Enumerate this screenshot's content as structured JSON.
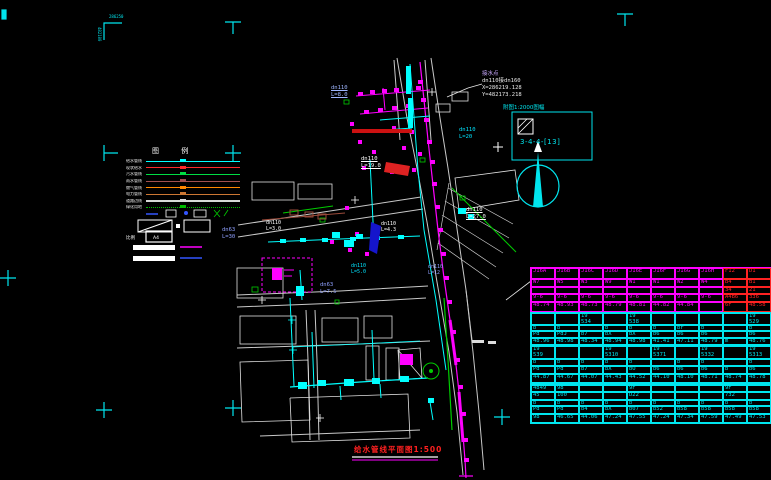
{
  "window": {
    "background": "#000000"
  },
  "frame": {
    "corner_coord_x": "286250",
    "corner_coord_y": "482100"
  },
  "legend": {
    "title": "图 例",
    "items": [
      {
        "label": "给水管线",
        "color": "#00ffff"
      },
      {
        "label": "现状给水",
        "color": "#ff2a2a"
      },
      {
        "label": "污水管线",
        "color": "#00dd44"
      },
      {
        "label": "雨水管线",
        "color": "#a05050"
      },
      {
        "label": "燃气管线",
        "color": "#ff8800"
      },
      {
        "label": "电力管线",
        "color": "#cc7733"
      },
      {
        "label": "道路边线",
        "color": "#d8d8d8",
        "thick": true
      },
      {
        "label": "绿化用地",
        "color": "#00bb00",
        "style": "dotted"
      }
    ],
    "scale_label": "比例",
    "sheet_label": "A4"
  },
  "callout": {
    "line1": "接水点",
    "line2": "dn110接dn160",
    "line3": "X=286219.128",
    "line4": "Y=482173.218"
  },
  "inset": {
    "caption": "附图1:2000图幅",
    "code": "3-4-4-[13]"
  },
  "title_block": {
    "title": "给水管线平面图1:500"
  },
  "map": {
    "labels": [
      {
        "text": "dn110\nL=8.0",
        "x": 331,
        "y": 85,
        "color": "#9fb6ff",
        "size": 5.5,
        "underline": true
      },
      {
        "text": "dn110\nL=20",
        "x": 459,
        "y": 127,
        "color": "#00e5ff",
        "size": 5.5
      },
      {
        "text": "dn110\nL=19.0",
        "x": 361,
        "y": 156,
        "color": "#ffffff",
        "size": 5.5,
        "underline": true
      },
      {
        "text": "dn110\nL=27.0",
        "x": 466,
        "y": 207,
        "color": "#ffffff",
        "size": 5.5,
        "underline": true
      },
      {
        "text": "dn63\nL=30",
        "x": 222,
        "y": 227,
        "color": "#8fa0ff",
        "size": 5.5
      },
      {
        "text": "dn110\nL=3.0",
        "x": 266,
        "y": 220,
        "color": "#ffffff",
        "size": 5
      },
      {
        "text": "dn110\nL=4.3",
        "x": 381,
        "y": 221,
        "color": "#ffffff",
        "size": 5
      },
      {
        "text": "dn63\nL=7.5",
        "x": 320,
        "y": 282,
        "color": "#8fa0ff",
        "size": 5.5
      },
      {
        "text": "dn110\nL=5.0",
        "x": 351,
        "y": 263,
        "color": "#00e5ff",
        "size": 5
      },
      {
        "text": "dn110\nL=12",
        "x": 428,
        "y": 264,
        "color": "#8fa0ff",
        "size": 5
      },
      {
        "text": "286250",
        "x": 109,
        "y": 15,
        "color": "#00e5ee",
        "size": 4
      },
      {
        "text": "482100",
        "x": 96,
        "y": 27,
        "color": "#00e5ee",
        "size": 4,
        "vertical": true
      }
    ]
  },
  "table": {
    "groups": [
      {
        "top": 0,
        "border": "#ff00ff",
        "text": "#ff00ff",
        "alt_cols": [
          8,
          9
        ],
        "alt_color": "#ff2222",
        "row_h": [
          11,
          8,
          7,
          8,
          10
        ],
        "rows": [
          [
            "J16A",
            "J16B",
            "J16C",
            "J16D",
            "J16E",
            "J16F",
            "J16G",
            "J16H",
            "F12",
            "D1"
          ],
          [
            "W7",
            "W5",
            "W3",
            "W9",
            "W1",
            "W1",
            "W2",
            "W4",
            "B4",
            "B1"
          ],
          [
            "",
            "",
            "",
            "",
            "",
            "",
            "",
            "",
            "34",
            "21"
          ],
          [
            "9-6",
            "9-6",
            "9-6",
            "9-6",
            "9-6",
            "9-6",
            "9-6",
            "9-6",
            "A4B6",
            "336"
          ],
          [
            "48.74",
            "48.93",
            "48.73",
            "48.79",
            "48.81",
            "44.82",
            "44.84",
            "",
            "6F",
            "48.58"
          ]
        ]
      },
      {
        "top": 45,
        "border": "#00e5ee",
        "text": "#00e5ee",
        "row_h": [
          12,
          6,
          7,
          7
        ],
        "rows": [
          [
            "",
            "",
            "19\n534",
            "",
            "19\n538",
            "",
            "",
            "",
            "",
            "19\n529"
          ],
          [
            "b",
            "b",
            "",
            "b",
            "b",
            "b",
            "br",
            "b",
            "",
            "b"
          ],
          [
            "Pd",
            "PdJ",
            "b7",
            "bX",
            "bX",
            "b6",
            "b6",
            "b6",
            "",
            "b6"
          ],
          [
            "48.96",
            "48.98",
            "48.34",
            "48.94",
            "48.98",
            "41.41",
            "47.11",
            "48.79",
            "m",
            "48.76"
          ]
        ]
      },
      {
        "top": 78,
        "border": "#00e5ee",
        "text": "#00e5ee",
        "row_h": [
          13,
          7,
          8,
          9
        ],
        "rows": [
          [
            "19\n539",
            "",
            "",
            "19\n5310",
            "",
            "19\n5371",
            "",
            "19\n5332",
            "",
            "19\n5313"
          ],
          [
            "b",
            "b",
            "b",
            "b",
            "b",
            "",
            "b",
            "b",
            "",
            "b"
          ],
          [
            "Pd",
            "Pd",
            "b7",
            "bX",
            "bO",
            "b6",
            "b6",
            "b6",
            "b",
            "b6"
          ],
          [
            "44.87",
            "44.67",
            "44.07",
            "44.43",
            "44.52",
            "44.10",
            "48.10",
            "48.71",
            "48.74",
            "48.78"
          ]
        ]
      },
      {
        "top": 117,
        "border": "#00e5ee",
        "text": "#00e5ee",
        "row_h": [
          7,
          8,
          6,
          8,
          9
        ],
        "rows": [
          [
            "4849",
            "98",
            "",
            "",
            "9F",
            "",
            "",
            "",
            "9F",
            ""
          ],
          [
            "45",
            "100",
            "",
            "",
            "D22",
            "",
            "",
            "",
            "732",
            ""
          ],
          [
            "b",
            "b",
            "b",
            "b",
            "b",
            "b",
            "b",
            "b",
            "b",
            "b"
          ],
          [
            "Pd",
            "Pd",
            "b4",
            "bX",
            "b07",
            "b52",
            "b58",
            "b58",
            "b58",
            "b58"
          ],
          [
            "98",
            "46.65",
            "44.06",
            "47.24",
            "47.55",
            "47.24",
            "47.34",
            "47.59",
            "47.49",
            "47.53"
          ]
        ]
      }
    ]
  }
}
